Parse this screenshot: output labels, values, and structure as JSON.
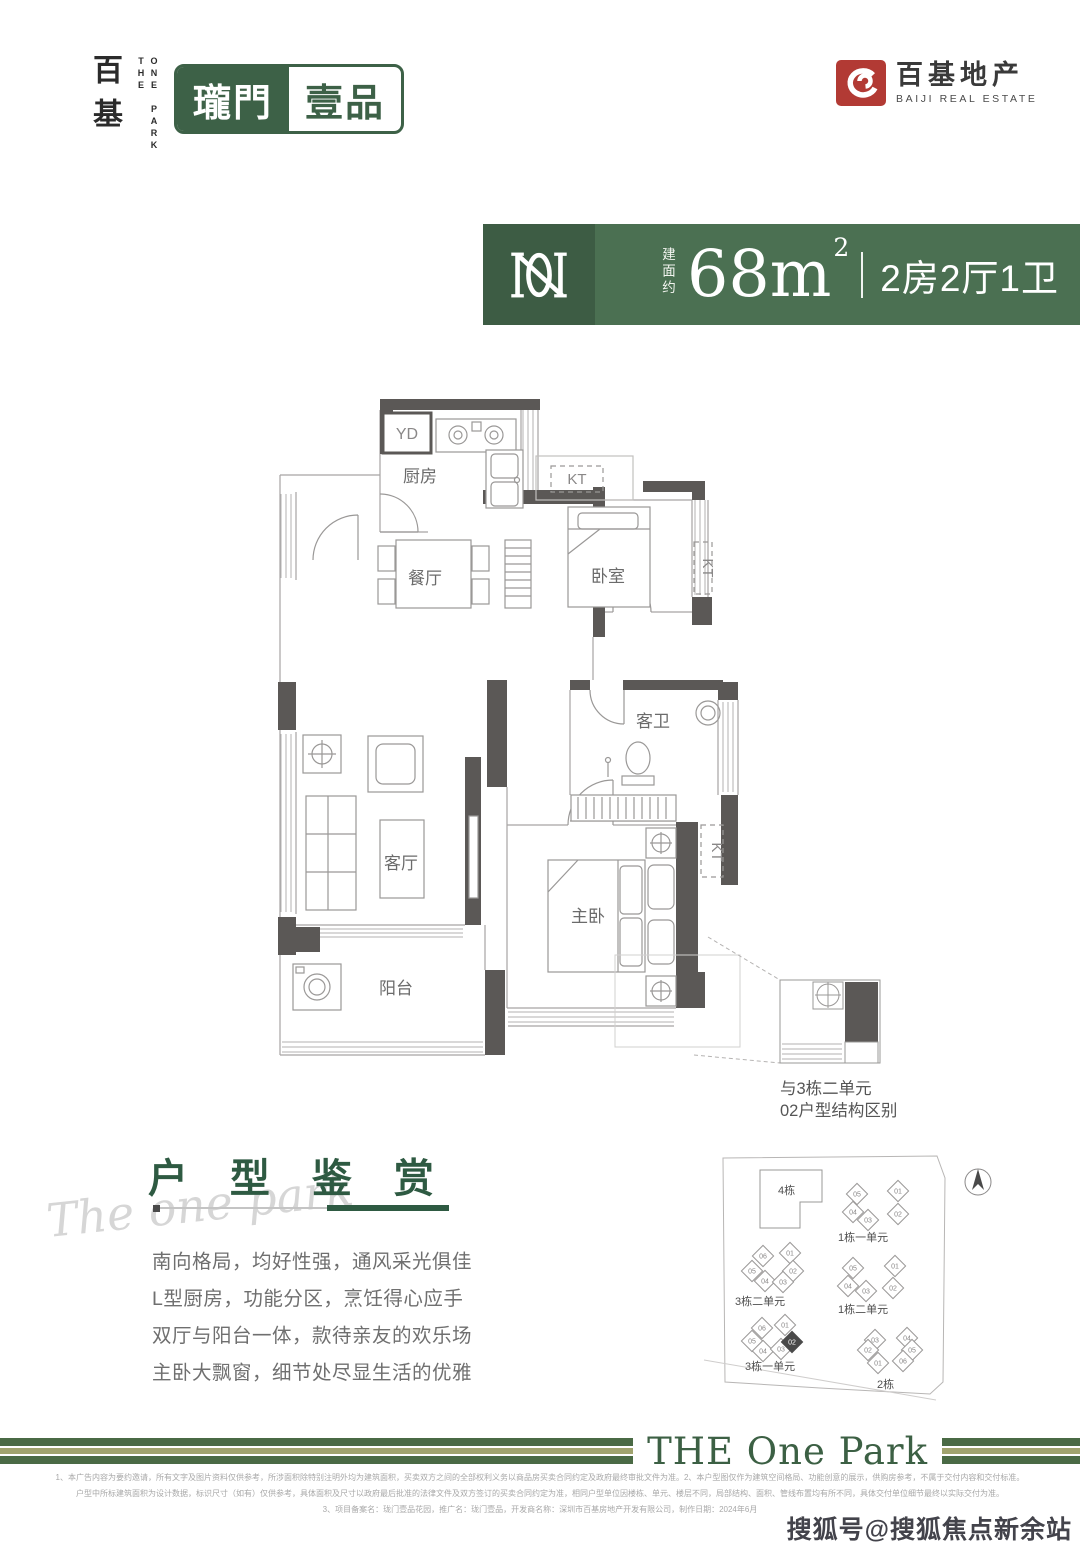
{
  "header": {
    "logo_vertical_cn": "百基",
    "logo_en_col1": "THE",
    "logo_en_col2": "ONE PARK",
    "brand_left": "瓏門",
    "brand_right": "壹品",
    "developer_cn": "百基地产",
    "developer_en": "BAIJI REAL ESTATE"
  },
  "banner": {
    "area_prefix": "建面约",
    "area_value": "68m",
    "area_sup": "2",
    "layout": "2房2厅1卫"
  },
  "floorplan": {
    "labels": {
      "yd": "YD",
      "kt": "KT",
      "kitchen": "厨房",
      "dining": "餐厅",
      "bedroom": "卧室",
      "guest_bath": "客卫",
      "living": "客厅",
      "master": "主卧",
      "balcony": "阳台"
    },
    "note_line1": "与3栋二单元",
    "note_line2": "02户型结构区别"
  },
  "appreciation": {
    "script": "The one park",
    "title": "户 型 鉴 赏",
    "lines": [
      "南向格局，均好性强，通风采光俱佳",
      "L型厨房，功能分区，烹饪得心应手",
      "双厅与阳台一体，款待亲友的欢乐场",
      "主卧大飘窗，细节处尽显生活的优雅"
    ]
  },
  "site_plan": {
    "block4": "4栋",
    "clusters": [
      {
        "label": "1栋一单元",
        "lx": 138,
        "ly": 113,
        "units": [
          {
            "n": "05",
            "x": 157,
            "y": 66
          },
          {
            "n": "01",
            "x": 198,
            "y": 63
          },
          {
            "n": "04",
            "x": 153,
            "y": 84
          },
          {
            "n": "03",
            "x": 168,
            "y": 92
          },
          {
            "n": "02",
            "x": 198,
            "y": 86
          }
        ]
      },
      {
        "label": "1栋二单元",
        "lx": 138,
        "ly": 185,
        "units": [
          {
            "n": "05",
            "x": 153,
            "y": 140
          },
          {
            "n": "01",
            "x": 195,
            "y": 138
          },
          {
            "n": "04",
            "x": 148,
            "y": 158
          },
          {
            "n": "03",
            "x": 166,
            "y": 163
          },
          {
            "n": "02",
            "x": 193,
            "y": 160
          }
        ]
      },
      {
        "label": "3栋二单元",
        "lx": 35,
        "ly": 177,
        "units": [
          {
            "n": "06",
            "x": 63,
            "y": 128
          },
          {
            "n": "01",
            "x": 90,
            "y": 125
          },
          {
            "n": "05",
            "x": 52,
            "y": 143
          },
          {
            "n": "02",
            "x": 93,
            "y": 143
          },
          {
            "n": "04",
            "x": 65,
            "y": 153
          },
          {
            "n": "03",
            "x": 83,
            "y": 154
          }
        ]
      },
      {
        "label": "3栋一单元",
        "lx": 45,
        "ly": 242,
        "units": [
          {
            "n": "06",
            "x": 62,
            "y": 200
          },
          {
            "n": "01",
            "x": 85,
            "y": 197
          },
          {
            "n": "05",
            "x": 52,
            "y": 213
          },
          {
            "n": "04",
            "x": 63,
            "y": 223
          },
          {
            "n": "03",
            "x": 81,
            "y": 221
          },
          {
            "n": "02",
            "x": 92,
            "y": 214,
            "hl": true
          }
        ]
      },
      {
        "label": "2栋",
        "lx": 177,
        "ly": 260,
        "units": [
          {
            "n": "03",
            "x": 175,
            "y": 212
          },
          {
            "n": "04",
            "x": 207,
            "y": 210
          },
          {
            "n": "02",
            "x": 168,
            "y": 222
          },
          {
            "n": "05",
            "x": 212,
            "y": 222
          },
          {
            "n": "01",
            "x": 178,
            "y": 235
          },
          {
            "n": "06",
            "x": 203,
            "y": 233
          }
        ]
      }
    ]
  },
  "footer": {
    "band_text": "THE One Park",
    "disclaimers": [
      "1、本广告内容为要约邀请，所有文字及图片资料仅供参考，所涉面积除特别注明外均为建筑面积，买卖双方之间的全部权利义务以商品房买卖合同约定及政府最终审批文件为准。2、本户型图仅作为建筑空间格局、功能创意的展示，供购房参考，不属于交付内容和交付标准。",
      "户型中所标建筑面积为设计数据，标识尺寸（如有）仅供参考，具体面积及尺寸以政府最后批准的法律文件及双方签订的买卖合同约定为准，相同户型单位因楼栋、单元、楼层不同，局部结构、面积、管线布置均有所不同，具体交付单位细节最终以实际交付为准。",
      "3、项目备案名：珑门壹品花园，推广名：珑门壹品，开发商名称：深圳市百基房地产开发有限公司，制作日期：2024年6月"
    ]
  },
  "watermark": "搜狐号@搜狐焦点新余站",
  "colors": {
    "brand_green": "#3d6147",
    "banner_green": "#4b7052",
    "banner_dark_green": "#3d5c44",
    "heading_green": "#2e5a42",
    "band_green": "#4a6a45",
    "band_olive": "#a0a36e",
    "logo_red": "#b23a34",
    "wall_gray": "#5b5856"
  }
}
